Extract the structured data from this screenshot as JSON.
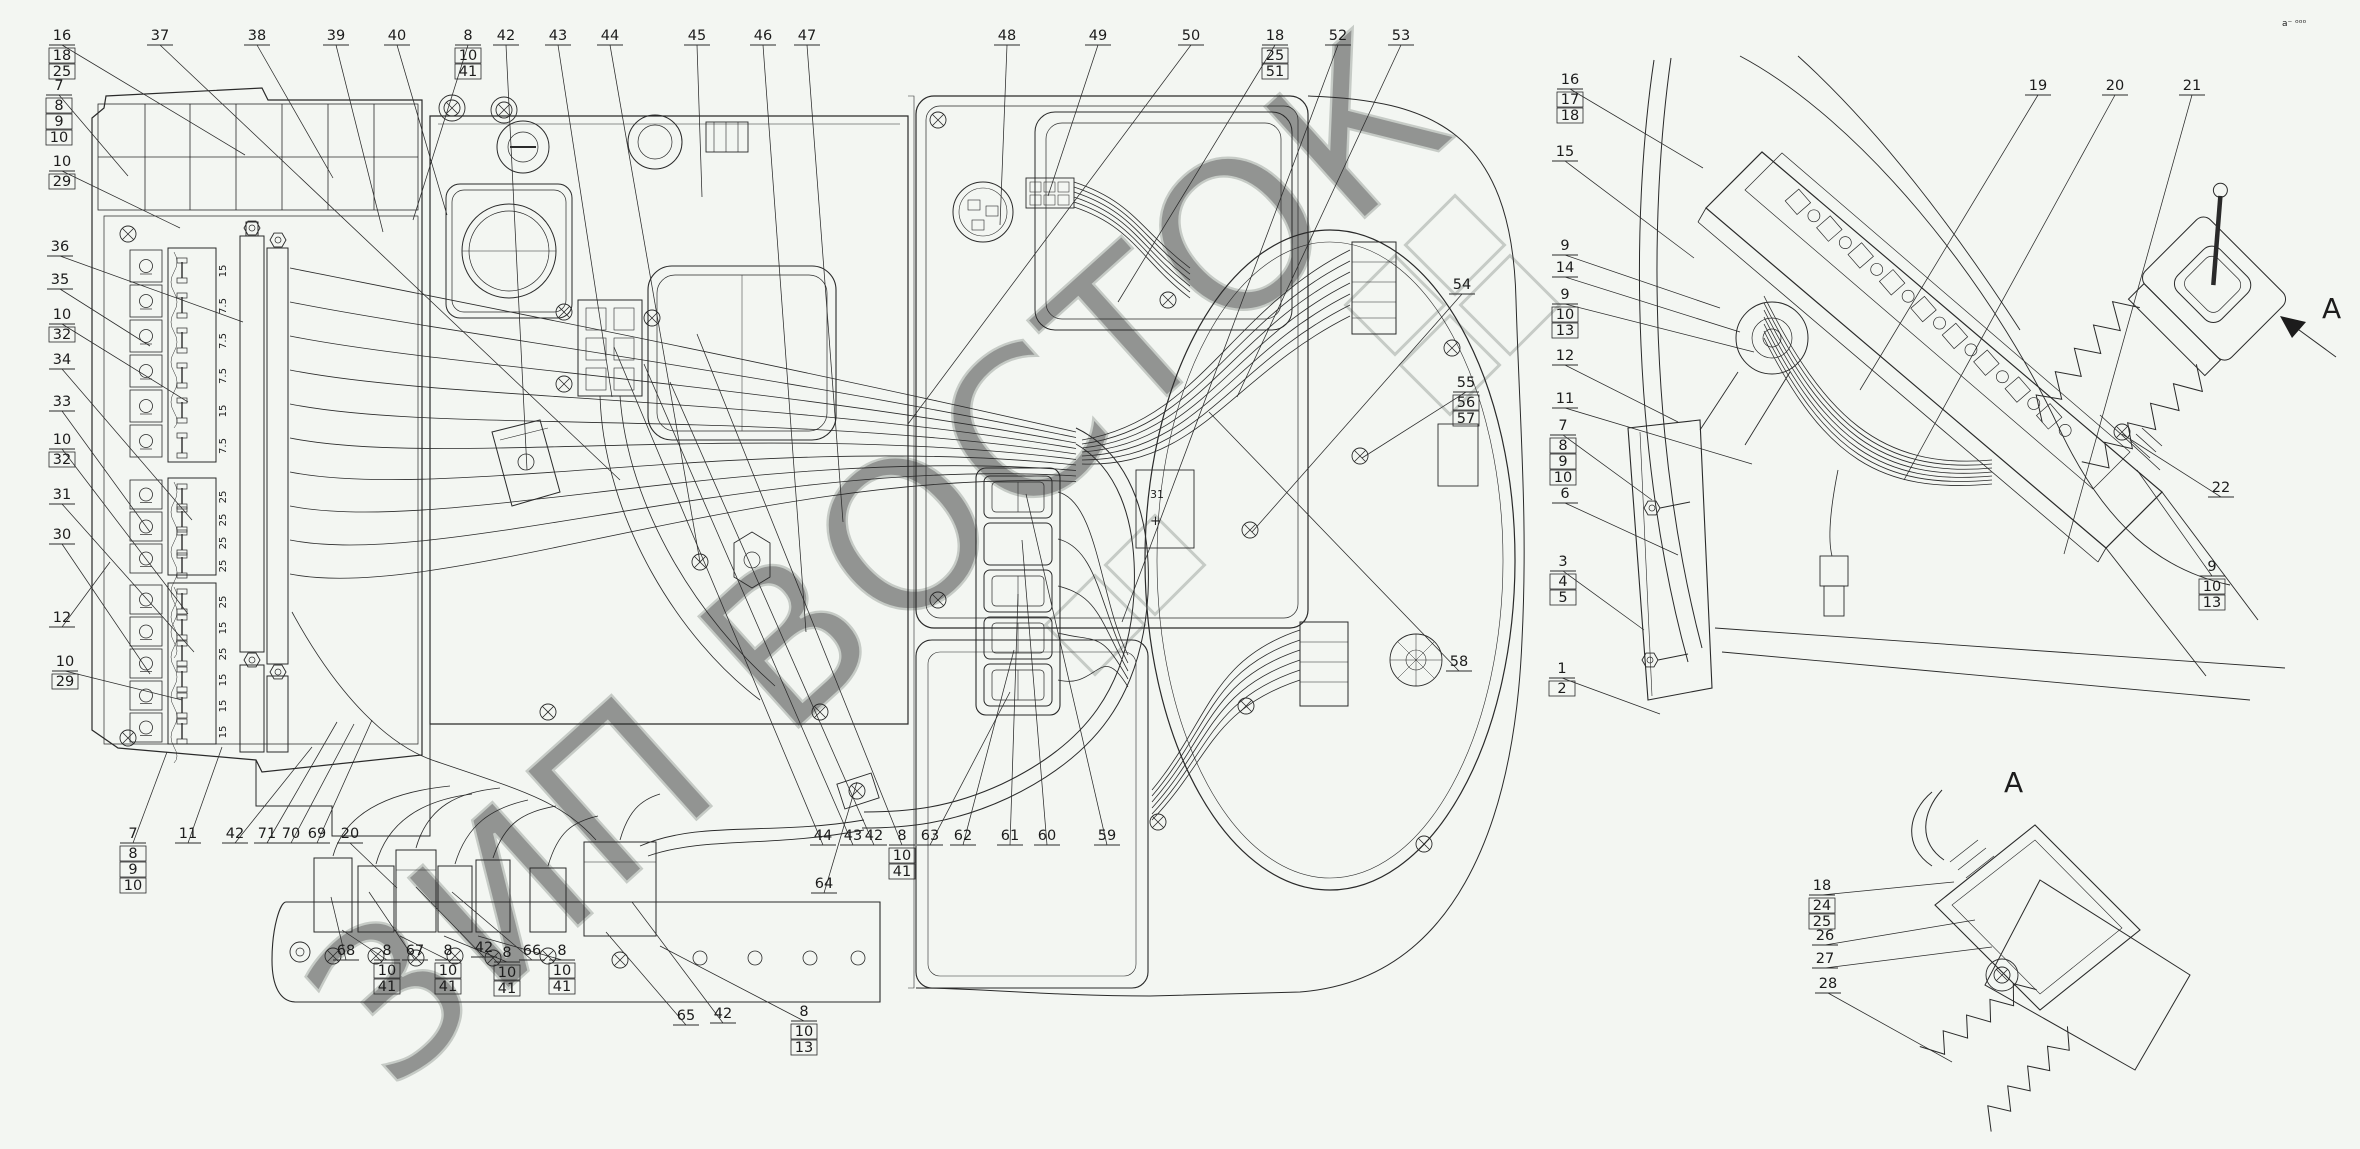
{
  "drawing": {
    "background": "#f3f6f2",
    "line_color": "#2a2a2a",
    "watermark": {
      "text": "ЗИП ВОСТОК",
      "color": "#8f968f",
      "rotation": -42
    },
    "corner_marks": "a⁻ ᵒᵒᵒ",
    "side_view_arrow_label": "A",
    "detail_view_title": "A",
    "battery_terminal": {
      "top": "31",
      "plus": "+"
    }
  },
  "fuse_blocks": [
    {
      "name": "fuse-block-1",
      "x": 168,
      "y": 248,
      "h": 214,
      "n": 6,
      "dy": 35,
      "y0": 262,
      "ratings": [
        "15",
        "7.5",
        "7.5",
        "7.5",
        "15",
        "7.5"
      ]
    },
    {
      "name": "fuse-block-2",
      "x": 168,
      "y": 478,
      "h": 97,
      "n": 4,
      "dy": 23,
      "y0": 488,
      "ratings": [
        "25",
        "25",
        "25",
        "25"
      ]
    },
    {
      "name": "fuse-block-3",
      "x": 168,
      "y": 583,
      "h": 161,
      "n": 6,
      "dy": 26,
      "y0": 593,
      "ratings": [
        "25",
        "15",
        "25",
        "15",
        "15",
        "15"
      ]
    }
  ],
  "icon_strips": [
    {
      "x": 130,
      "y": 250,
      "dy": 35,
      "icons": [
        "updown-arrows-icon",
        "gauge-icon",
        "lamp-low-icon",
        "lamp-high-icon",
        "gauge-30-icon",
        "wiper-icon"
      ]
    },
    {
      "x": 130,
      "y": 480,
      "dy": 32,
      "icons": [
        "fan-icon",
        "battery-icon",
        "lighter-icon"
      ]
    },
    {
      "x": 130,
      "y": 585,
      "dy": 32,
      "icons": [
        "bulb-icon",
        "horn-icon",
        "fan2-icon",
        "worklamp-icon",
        "ring-icon"
      ]
    }
  ],
  "switch_stack": {
    "x": 984,
    "y": 476,
    "w": 68,
    "h": 42,
    "dy": 47,
    "n": 5,
    "names": [
      "rocker-switch-1",
      "blank-plug",
      "rocker-switch-2",
      "rocker-switch-3",
      "rocker-switch-4"
    ]
  },
  "callouts": [
    {
      "n": "16",
      "x": 62,
      "y": 40,
      "subs": [
        "18",
        "25"
      ],
      "t": [
        245,
        155
      ]
    },
    {
      "n": "37",
      "x": 160,
      "y": 40,
      "subs": [],
      "t": [
        620,
        480
      ]
    },
    {
      "n": "38",
      "x": 257,
      "y": 40,
      "subs": [],
      "t": [
        333,
        178
      ]
    },
    {
      "n": "39",
      "x": 336,
      "y": 40,
      "subs": [],
      "t": [
        383,
        232
      ]
    },
    {
      "n": "40",
      "x": 397,
      "y": 40,
      "subs": [],
      "t": [
        447,
        215
      ]
    },
    {
      "n": "8",
      "x": 468,
      "y": 40,
      "subs": [
        "10",
        "41"
      ],
      "t": [
        413,
        220
      ]
    },
    {
      "n": "42",
      "x": 506,
      "y": 40,
      "subs": [],
      "t": [
        527,
        470
      ]
    },
    {
      "n": "43",
      "x": 558,
      "y": 40,
      "subs": [],
      "t": [
        612,
        397
      ]
    },
    {
      "n": "44",
      "x": 610,
      "y": 40,
      "subs": [],
      "t": [
        700,
        562
      ]
    },
    {
      "n": "45",
      "x": 697,
      "y": 40,
      "subs": [],
      "t": [
        702,
        197
      ]
    },
    {
      "n": "46",
      "x": 763,
      "y": 40,
      "subs": [],
      "t": [
        806,
        632
      ]
    },
    {
      "n": "47",
      "x": 807,
      "y": 40,
      "subs": [],
      "t": [
        843,
        522
      ]
    },
    {
      "n": "48",
      "x": 1007,
      "y": 40,
      "subs": [],
      "t": [
        1000,
        225
      ]
    },
    {
      "n": "49",
      "x": 1098,
      "y": 40,
      "subs": [],
      "t": [
        1048,
        196
      ]
    },
    {
      "n": "50",
      "x": 1191,
      "y": 40,
      "subs": [],
      "t": [
        908,
        424
      ]
    },
    {
      "n": "18",
      "x": 1275,
      "y": 40,
      "subs": [
        "25",
        "51"
      ],
      "t": [
        1118,
        302
      ]
    },
    {
      "n": "52",
      "x": 1338,
      "y": 40,
      "subs": [],
      "t": [
        1122,
        622
      ]
    },
    {
      "n": "53",
      "x": 1401,
      "y": 40,
      "subs": [],
      "t": [
        1237,
        397
      ]
    },
    {
      "n": "54",
      "x": 1462,
      "y": 289,
      "subs": [],
      "t": [
        1252,
        532
      ]
    },
    {
      "n": "55",
      "x": 1466,
      "y": 387,
      "subs": [
        "56",
        "57"
      ],
      "t": [
        1362,
        458
      ]
    },
    {
      "n": "58",
      "x": 1459,
      "y": 666,
      "subs": [],
      "t": [
        1209,
        412
      ]
    },
    {
      "n": "7",
      "x": 59,
      "y": 90,
      "subs": [
        "8",
        "9",
        "10"
      ],
      "t": [
        128,
        176
      ]
    },
    {
      "n": "10",
      "x": 62,
      "y": 166,
      "subs": [
        "29"
      ],
      "t": [
        180,
        228
      ]
    },
    {
      "n": "36",
      "x": 60,
      "y": 251,
      "subs": [],
      "t": [
        243,
        322
      ]
    },
    {
      "n": "35",
      "x": 60,
      "y": 284,
      "subs": [],
      "t": [
        150,
        346
      ]
    },
    {
      "n": "10",
      "x": 62,
      "y": 319,
      "subs": [
        "32"
      ],
      "t": [
        188,
        402
      ]
    },
    {
      "n": "34",
      "x": 62,
      "y": 364,
      "subs": [],
      "t": [
        192,
        520
      ]
    },
    {
      "n": "33",
      "x": 62,
      "y": 406,
      "subs": [],
      "t": [
        150,
        532
      ]
    },
    {
      "n": "10",
      "x": 62,
      "y": 444,
      "subs": [
        "32"
      ],
      "t": [
        188,
        614
      ]
    },
    {
      "n": "31",
      "x": 62,
      "y": 499,
      "subs": [],
      "t": [
        194,
        652
      ]
    },
    {
      "n": "30",
      "x": 62,
      "y": 539,
      "subs": [],
      "t": [
        150,
        674
      ]
    },
    {
      "n": "12",
      "x": 62,
      "y": 622,
      "subs": [],
      "t": [
        110,
        562
      ]
    },
    {
      "n": "10",
      "x": 65,
      "y": 666,
      "subs": [
        "29"
      ],
      "t": [
        182,
        700
      ]
    },
    {
      "n": "7",
      "x": 133,
      "y": 838,
      "subs": [
        "8",
        "9",
        "10"
      ],
      "t": [
        167,
        752
      ]
    },
    {
      "n": "11",
      "x": 188,
      "y": 838,
      "subs": [],
      "t": [
        222,
        747
      ]
    },
    {
      "n": "42",
      "x": 235,
      "y": 838,
      "subs": [],
      "t": [
        312,
        747
      ]
    },
    {
      "n": "71",
      "x": 267,
      "y": 838,
      "subs": [],
      "t": [
        337,
        722
      ]
    },
    {
      "n": "70",
      "x": 291,
      "y": 838,
      "subs": [],
      "t": [
        354,
        724
      ]
    },
    {
      "n": "69",
      "x": 317,
      "y": 838,
      "subs": [],
      "t": [
        372,
        720
      ]
    },
    {
      "n": "20",
      "x": 350,
      "y": 838,
      "subs": [],
      "t": [
        397,
        888
      ]
    },
    {
      "n": "68",
      "x": 346,
      "y": 955,
      "subs": [],
      "t": [
        331,
        897
      ]
    },
    {
      "n": "8",
      "x": 387,
      "y": 955,
      "subs": [
        "10",
        "41"
      ],
      "t": [
        342,
        930
      ]
    },
    {
      "n": "67",
      "x": 415,
      "y": 955,
      "subs": [],
      "t": [
        369,
        892
      ]
    },
    {
      "n": "8",
      "x": 448,
      "y": 955,
      "subs": [
        "10",
        "41"
      ],
      "t": [
        400,
        936
      ]
    },
    {
      "n": "42",
      "x": 484,
      "y": 952,
      "subs": [],
      "t": [
        416,
        887
      ]
    },
    {
      "n": "8",
      "x": 507,
      "y": 957,
      "subs": [
        "10",
        "41"
      ],
      "t": [
        444,
        936
      ]
    },
    {
      "n": "66",
      "x": 532,
      "y": 955,
      "subs": [],
      "t": [
        452,
        892
      ]
    },
    {
      "n": "8",
      "x": 562,
      "y": 955,
      "subs": [
        "10",
        "41"
      ],
      "t": [
        478,
        936
      ]
    },
    {
      "n": "65",
      "x": 686,
      "y": 1020,
      "subs": [],
      "t": [
        606,
        932
      ]
    },
    {
      "n": "42",
      "x": 723,
      "y": 1018,
      "subs": [],
      "t": [
        632,
        902
      ]
    },
    {
      "n": "8",
      "x": 804,
      "y": 1016,
      "subs": [
        "10",
        "13"
      ],
      "t": [
        660,
        946
      ]
    },
    {
      "n": "44",
      "x": 823,
      "y": 840,
      "subs": [],
      "t": [
        614,
        347
      ]
    },
    {
      "n": "43",
      "x": 853,
      "y": 840,
      "subs": [],
      "t": [
        644,
        364
      ]
    },
    {
      "n": "42",
      "x": 874,
      "y": 840,
      "subs": [],
      "t": [
        670,
        382
      ]
    },
    {
      "n": "8",
      "x": 902,
      "y": 840,
      "subs": [
        "10",
        "41"
      ],
      "t": [
        697,
        334
      ]
    },
    {
      "n": "63",
      "x": 930,
      "y": 840,
      "subs": [],
      "t": [
        1010,
        692
      ]
    },
    {
      "n": "62",
      "x": 963,
      "y": 840,
      "subs": [],
      "t": [
        1014,
        650
      ]
    },
    {
      "n": "61",
      "x": 1010,
      "y": 840,
      "subs": [],
      "t": [
        1018,
        594
      ]
    },
    {
      "n": "60",
      "x": 1047,
      "y": 840,
      "subs": [],
      "t": [
        1022,
        540
      ]
    },
    {
      "n": "59",
      "x": 1107,
      "y": 840,
      "subs": [],
      "t": [
        1026,
        494
      ]
    },
    {
      "n": "64",
      "x": 824,
      "y": 888,
      "subs": [],
      "t": [
        857,
        782
      ]
    },
    {
      "n": "16",
      "x": 1570,
      "y": 84,
      "subs": [
        "17",
        "18"
      ],
      "t": [
        1703,
        168
      ]
    },
    {
      "n": "15",
      "x": 1565,
      "y": 156,
      "subs": [],
      "t": [
        1694,
        258
      ]
    },
    {
      "n": "9",
      "x": 1565,
      "y": 250,
      "subs": [],
      "t": [
        1720,
        308
      ]
    },
    {
      "n": "14",
      "x": 1565,
      "y": 272,
      "subs": [],
      "t": [
        1740,
        332
      ]
    },
    {
      "n": "9",
      "x": 1565,
      "y": 299,
      "subs": [
        "10",
        "13"
      ],
      "t": [
        1754,
        352
      ]
    },
    {
      "n": "12",
      "x": 1565,
      "y": 360,
      "subs": [],
      "t": [
        1678,
        422
      ]
    },
    {
      "n": "11",
      "x": 1565,
      "y": 403,
      "subs": [],
      "t": [
        1752,
        464
      ]
    },
    {
      "n": "7",
      "x": 1563,
      "y": 430,
      "subs": [
        "8",
        "9",
        "10"
      ],
      "t": [
        1652,
        500
      ]
    },
    {
      "n": "6",
      "x": 1565,
      "y": 498,
      "subs": [],
      "t": [
        1678,
        555
      ]
    },
    {
      "n": "3",
      "x": 1563,
      "y": 566,
      "subs": [
        "4",
        "5"
      ],
      "t": [
        1644,
        630
      ]
    },
    {
      "n": "1",
      "x": 1562,
      "y": 673,
      "subs": [
        "2"
      ],
      "t": [
        1660,
        714
      ]
    },
    {
      "n": "19",
      "x": 2038,
      "y": 90,
      "subs": [],
      "t": [
        1860,
        390
      ]
    },
    {
      "n": "20",
      "x": 2115,
      "y": 90,
      "subs": [],
      "t": [
        1904,
        480
      ]
    },
    {
      "n": "21",
      "x": 2192,
      "y": 90,
      "subs": [],
      "t": [
        2064,
        554
      ]
    },
    {
      "n": "22",
      "x": 2221,
      "y": 492,
      "subs": [],
      "t": [
        2122,
        434
      ]
    },
    {
      "n": "9",
      "x": 2212,
      "y": 571,
      "subs": [
        "10",
        "13"
      ],
      "t": [
        2137,
        470
      ]
    },
    {
      "n": "18",
      "x": 1822,
      "y": 890,
      "subs": [
        "24",
        "25"
      ],
      "t": [
        1954,
        882
      ]
    },
    {
      "n": "26",
      "x": 1825,
      "y": 940,
      "subs": [],
      "t": [
        1975,
        920
      ]
    },
    {
      "n": "27",
      "x": 1825,
      "y": 963,
      "subs": [],
      "t": [
        1992,
        947
      ]
    },
    {
      "n": "28",
      "x": 1828,
      "y": 988,
      "subs": [],
      "t": [
        1952,
        1062
      ]
    }
  ]
}
